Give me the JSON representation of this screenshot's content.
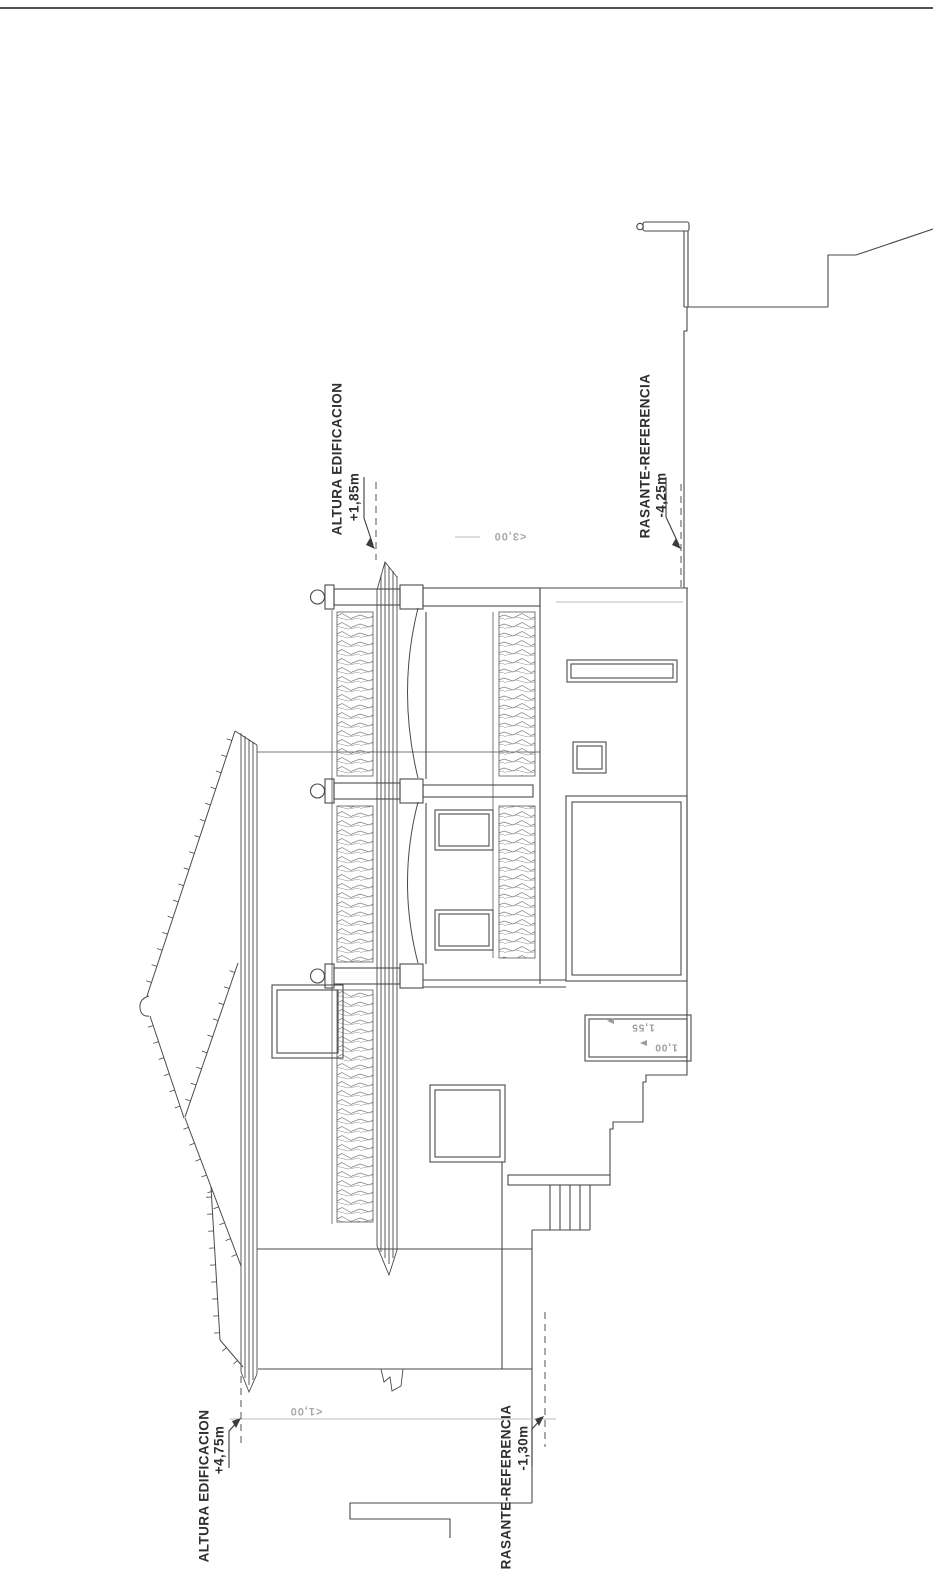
{
  "annotations": {
    "altura_top": {
      "label": "ALTURA EDIFICACION",
      "value": "+1,85m"
    },
    "rasante_top": {
      "label": "RASANTE-REFERENCIA",
      "value": "-4,25m"
    },
    "altura_left": {
      "label": "ALTURA EDIFICACION",
      "value": "+4,75m"
    },
    "rasante_left": {
      "label": "RASANTE-REFERENCIA",
      "value": "-1,30m"
    }
  },
  "dimensions": {
    "upper": "<3,00",
    "lower": "<1,00",
    "box_upper": "1,55",
    "box_lower": "1,00"
  },
  "colors": {
    "ink": "#4a4a4a",
    "faint": "#bbbbbb",
    "paper": "#ffffff"
  }
}
